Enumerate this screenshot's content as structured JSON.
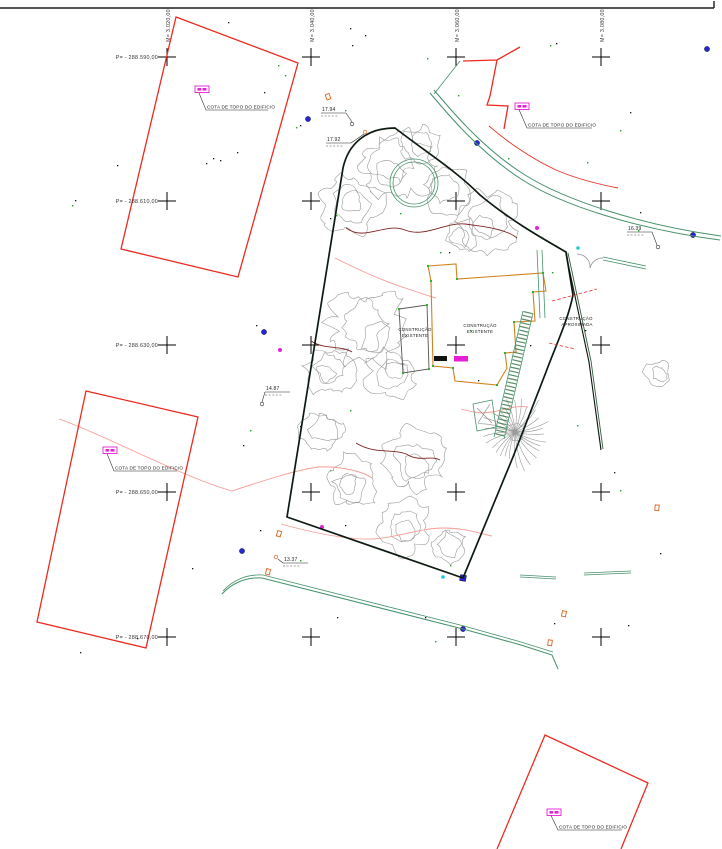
{
  "grid": {
    "m_labels": [
      "M= 3.020,00",
      "M= 3.040,00",
      "M= 3.060,00",
      "M= 3.080,00"
    ],
    "p_labels": [
      "P= - 288.590,00",
      "P= - 288.610,00",
      "P= - 288.630,00",
      "P= - 288.650,00",
      "P= - 288.670,00"
    ]
  },
  "annotations": {
    "cota_labels": [
      "COTA DE TOPO DO EDIFICIO",
      "COTA DE TOPO DO EDIFICIO",
      "COTA DE TOPO DO EDIFICIO",
      "COTA DE TOPO DO EDIFICIO"
    ],
    "measurements": [
      "17.94",
      "17.92",
      "14.87",
      "13.37",
      "16.39"
    ],
    "building_labels": {
      "existing_annex": {
        "line1": "CONSTRUÇÃO",
        "line2": "EXISTENTE"
      },
      "existing_main": {
        "line1": "CONSTRUÇÃO",
        "line2": "EXISTENTE"
      },
      "approximate": {
        "line1": "CONSTRUÇÃO",
        "line2": "APROXIMADA"
      }
    }
  },
  "colors": {
    "parcel_red": "#ec2a20",
    "curb_red": "#e83328",
    "road_green": "#46916a",
    "boundary_dark": "#0c1a10",
    "building_orange": "#d2821e",
    "label_magenta": "#e620d6",
    "tree_gray": "#9a9a9a",
    "contour_pink": "#f59c94",
    "fence_maroon": "#7e2420",
    "marker_blue": "#2626d8",
    "marker_cyan": "#19cdd6",
    "marker_orange": "#d8641e",
    "annex_gray": "#555555",
    "text_black": "#1a1a1a"
  }
}
